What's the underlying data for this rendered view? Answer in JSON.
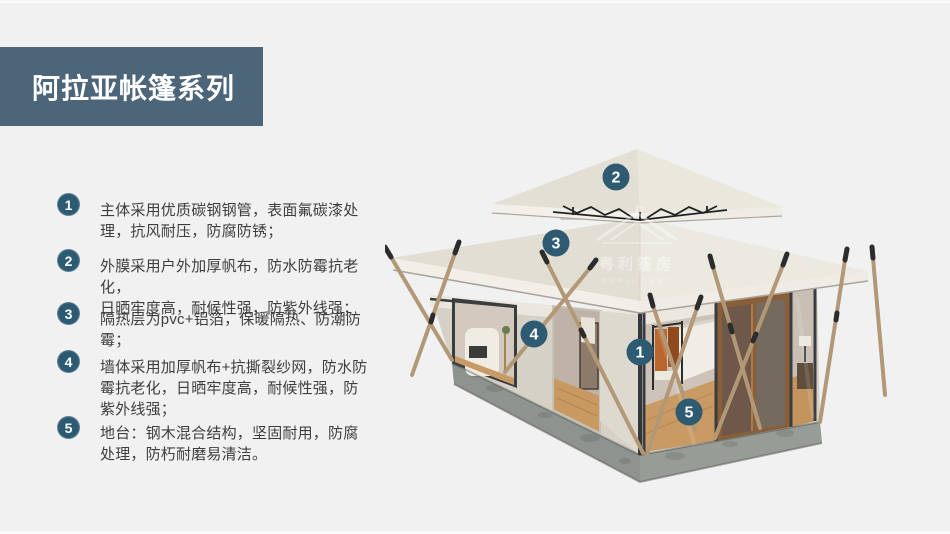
{
  "header": {
    "title": "阿拉亚帐篷系列"
  },
  "colors": {
    "page_bg": "#f1f1f2",
    "header_bg": "#4c6578",
    "header_text": "#ffffff",
    "badge_bg": "#2d5a73",
    "marker_bg": "#2e5a72",
    "body_text": "#3e3e3e",
    "roof_canvas": "#e9e5da",
    "platform_gray": "#8f938f"
  },
  "features": {
    "items": [
      {
        "num": "1",
        "text": "主体采用优质碳钢钢管，表面氟碳漆处\n理，抗风耐压，防腐防锈；"
      },
      {
        "num": "2",
        "text": "外膜采用户外加厚帆布，防水防霉抗老化，\n日晒牢度高，耐候性强，防紫外线强；"
      },
      {
        "num": "3",
        "text": "隔热层为pvc+铝箔，保暖隔热、防潮防\n霉；"
      },
      {
        "num": "4",
        "text": "墙体采用加厚帆布+抗撕裂纱网，防水防\n霉抗老化，日晒牢度高，耐候性强，防\n紫外线强；"
      },
      {
        "num": "5",
        "text": "地台：钢木混合结构，坚固耐用，防腐\n处理，防朽耐磨易清洁。"
      }
    ]
  },
  "tent": {
    "markers": [
      {
        "num": "1"
      },
      {
        "num": "2"
      },
      {
        "num": "3"
      },
      {
        "num": "4"
      },
      {
        "num": "5"
      }
    ],
    "watermark": {
      "cn": "粤利篷房",
      "en": "YUELI TENT"
    }
  }
}
